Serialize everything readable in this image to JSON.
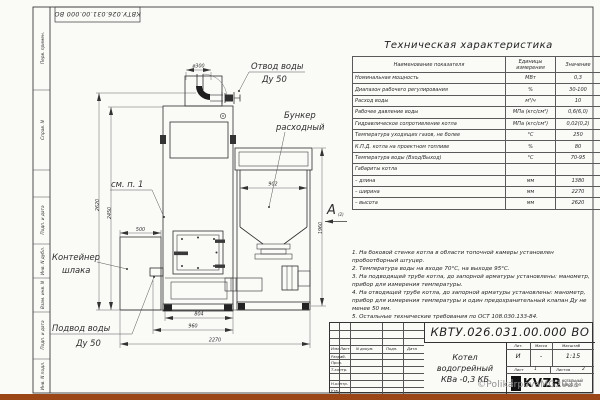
{
  "sheet": {
    "corner_stamp": "КВТУ.026.031.00.000 ВО",
    "side_labels": {
      "perv": "Перв. примен.",
      "sprav": "Справ. N",
      "podp1": "Подп. и дата",
      "inv_dubl": "Инв. N дубл.",
      "vzam": "Взам. инв. N",
      "podp2": "Подп. и дата",
      "inv_podl": "Инв. N подл."
    }
  },
  "spec_table": {
    "title": "Техническая характеристика",
    "headers": [
      "Наименование показателя",
      "Единицы измерения",
      "Значение"
    ],
    "rows": [
      [
        "Номинальная мощность",
        "МВт",
        "0,3"
      ],
      [
        "Диапазон рабочего регулирования",
        "%",
        "30-100"
      ],
      [
        "Расход воды",
        "м³/ч",
        "10"
      ],
      [
        "Рабочее давление воды",
        "МПа (кгс/см²)",
        "0,6(6,0)"
      ],
      [
        "Гидравлическое сопротивление котла",
        "МПа (кгс/см²)",
        "0,02(0,2)"
      ],
      [
        "Температура уходящих газов, не более",
        "°С",
        "250"
      ],
      [
        "К.П.Д. котла на проектном топливе",
        "%",
        "80"
      ],
      [
        "Температура воды (Вход/Выход)",
        "°С",
        "70-95"
      ],
      [
        "Габариты котла",
        "",
        ""
      ],
      [
        "– длина",
        "мм",
        "1380"
      ],
      [
        "– ширина",
        "мм",
        "2270"
      ],
      [
        "– высота",
        "мм",
        "2620"
      ]
    ]
  },
  "notes": [
    "1. На боковой стенке котла в области топочной камеры установлен пробоотборный штуцер.",
    "2. Температура воды на входе 70°С, на выходе 95°С.",
    "3. На подводящей трубе котла, до запорной арматуры установлены: манометр, прибор для измерения температуры.",
    "4. На отводящей трубе котла, до запорной арматуры установлены: манометр, прибор для измерения температуры и один предохранительный клапан Ду не менее 50 мм.",
    "5. Остальные технические требования по ОСТ 108.030.133-84."
  ],
  "drawing": {
    "labels": {
      "outlet1": "Отвод воды",
      "outlet2": "Ду 50",
      "bunker1": "Бункер",
      "bunker2": "расходный",
      "see_note": "см. п. 1",
      "slag1": "Контейнер",
      "slag2": "шлака",
      "inlet1": "Подвод воды",
      "inlet2": "Ду 50",
      "view_letter": "А",
      "view_ref": "(2)"
    },
    "dims": {
      "dia": "ø300",
      "h_total": "2620",
      "h_body": "2450",
      "slag_w": "500",
      "bunker_w": "902",
      "bunker_h": "1960",
      "w_door": "804",
      "w_body": "960",
      "w_total": "2270"
    }
  },
  "title_block": {
    "doc_number": "КВТУ.026.031.00.000  ВО",
    "product_line1": "Котел водогрейный",
    "product_line2": "КВа -0,3 КБ",
    "col_izm": "Изм.",
    "col_list": "Лист",
    "col_dokum": "N докум.",
    "col_podp": "Подп.",
    "col_data": "Дата",
    "row_razrab": "Разраб.",
    "row_prov": "Пров.",
    "row_tkontr": "Т.контр.",
    "row_nkontr": "Н.контр.",
    "row_utv": "Утв.",
    "lit_label": "Лит.",
    "lit_value": "И",
    "mass_label": "Масса",
    "mass_value": "-",
    "scale_label": "Масштаб",
    "scale_value": "1:15",
    "sheet_label": "Лист",
    "sheet_value": "1",
    "sheets_label": "Листов",
    "sheets_value": "2",
    "logo_box": "ООО",
    "logo_text": "KVZR",
    "logo_sub1": "КОТЕЛЬНЫЙ",
    "logo_sub2": "ЗАВОД РЭП",
    "watermark": "©PolikarpovaMG2021"
  }
}
